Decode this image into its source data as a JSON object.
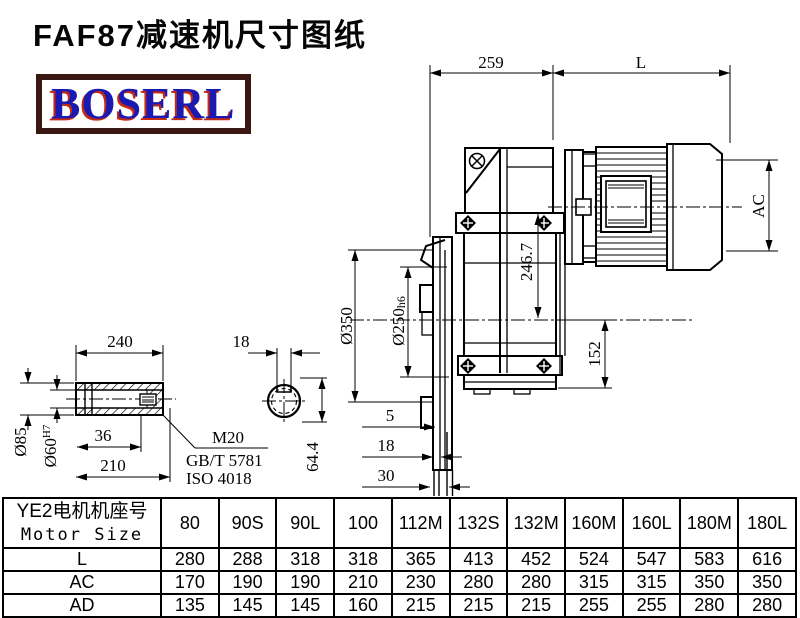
{
  "title": "FAF87减速机尺寸图纸",
  "logo": {
    "text": "BOSERL",
    "text_color": "#1a1ab2",
    "shadow_color": "#c52a10",
    "border_color": "#3a1712"
  },
  "drawing": {
    "dims": {
      "d259": "259",
      "L": "L",
      "AC": "AC",
      "d350": "Ø350",
      "d250": "Ø250",
      "d250_tol": "h6",
      "d246_7": "246.7",
      "d152": "152",
      "f5": "5",
      "f18": "18",
      "f30": "30",
      "s240": "240",
      "key18": "18",
      "d85": "Ø85",
      "d60": "Ø60",
      "d60_tol": "H7",
      "s36": "36",
      "s210": "210",
      "m20": "M20",
      "gbt": "GB/T 5781",
      "iso": "ISO 4018",
      "k64_4": "64.4"
    }
  },
  "table": {
    "header_cn": "YE2电机机座号",
    "header_en": "Motor Size",
    "columns": [
      "80",
      "90S",
      "90L",
      "100",
      "112M",
      "132S",
      "132M",
      "160M",
      "160L",
      "180M",
      "180L"
    ],
    "rows": [
      {
        "label": "L",
        "values": [
          "280",
          "288",
          "318",
          "318",
          "365",
          "413",
          "452",
          "524",
          "547",
          "583",
          "616"
        ]
      },
      {
        "label": "AC",
        "values": [
          "170",
          "190",
          "190",
          "210",
          "230",
          "280",
          "280",
          "315",
          "315",
          "350",
          "350"
        ]
      },
      {
        "label": "AD",
        "values": [
          "135",
          "145",
          "145",
          "160",
          "215",
          "215",
          "215",
          "255",
          "255",
          "280",
          "280"
        ]
      }
    ]
  }
}
